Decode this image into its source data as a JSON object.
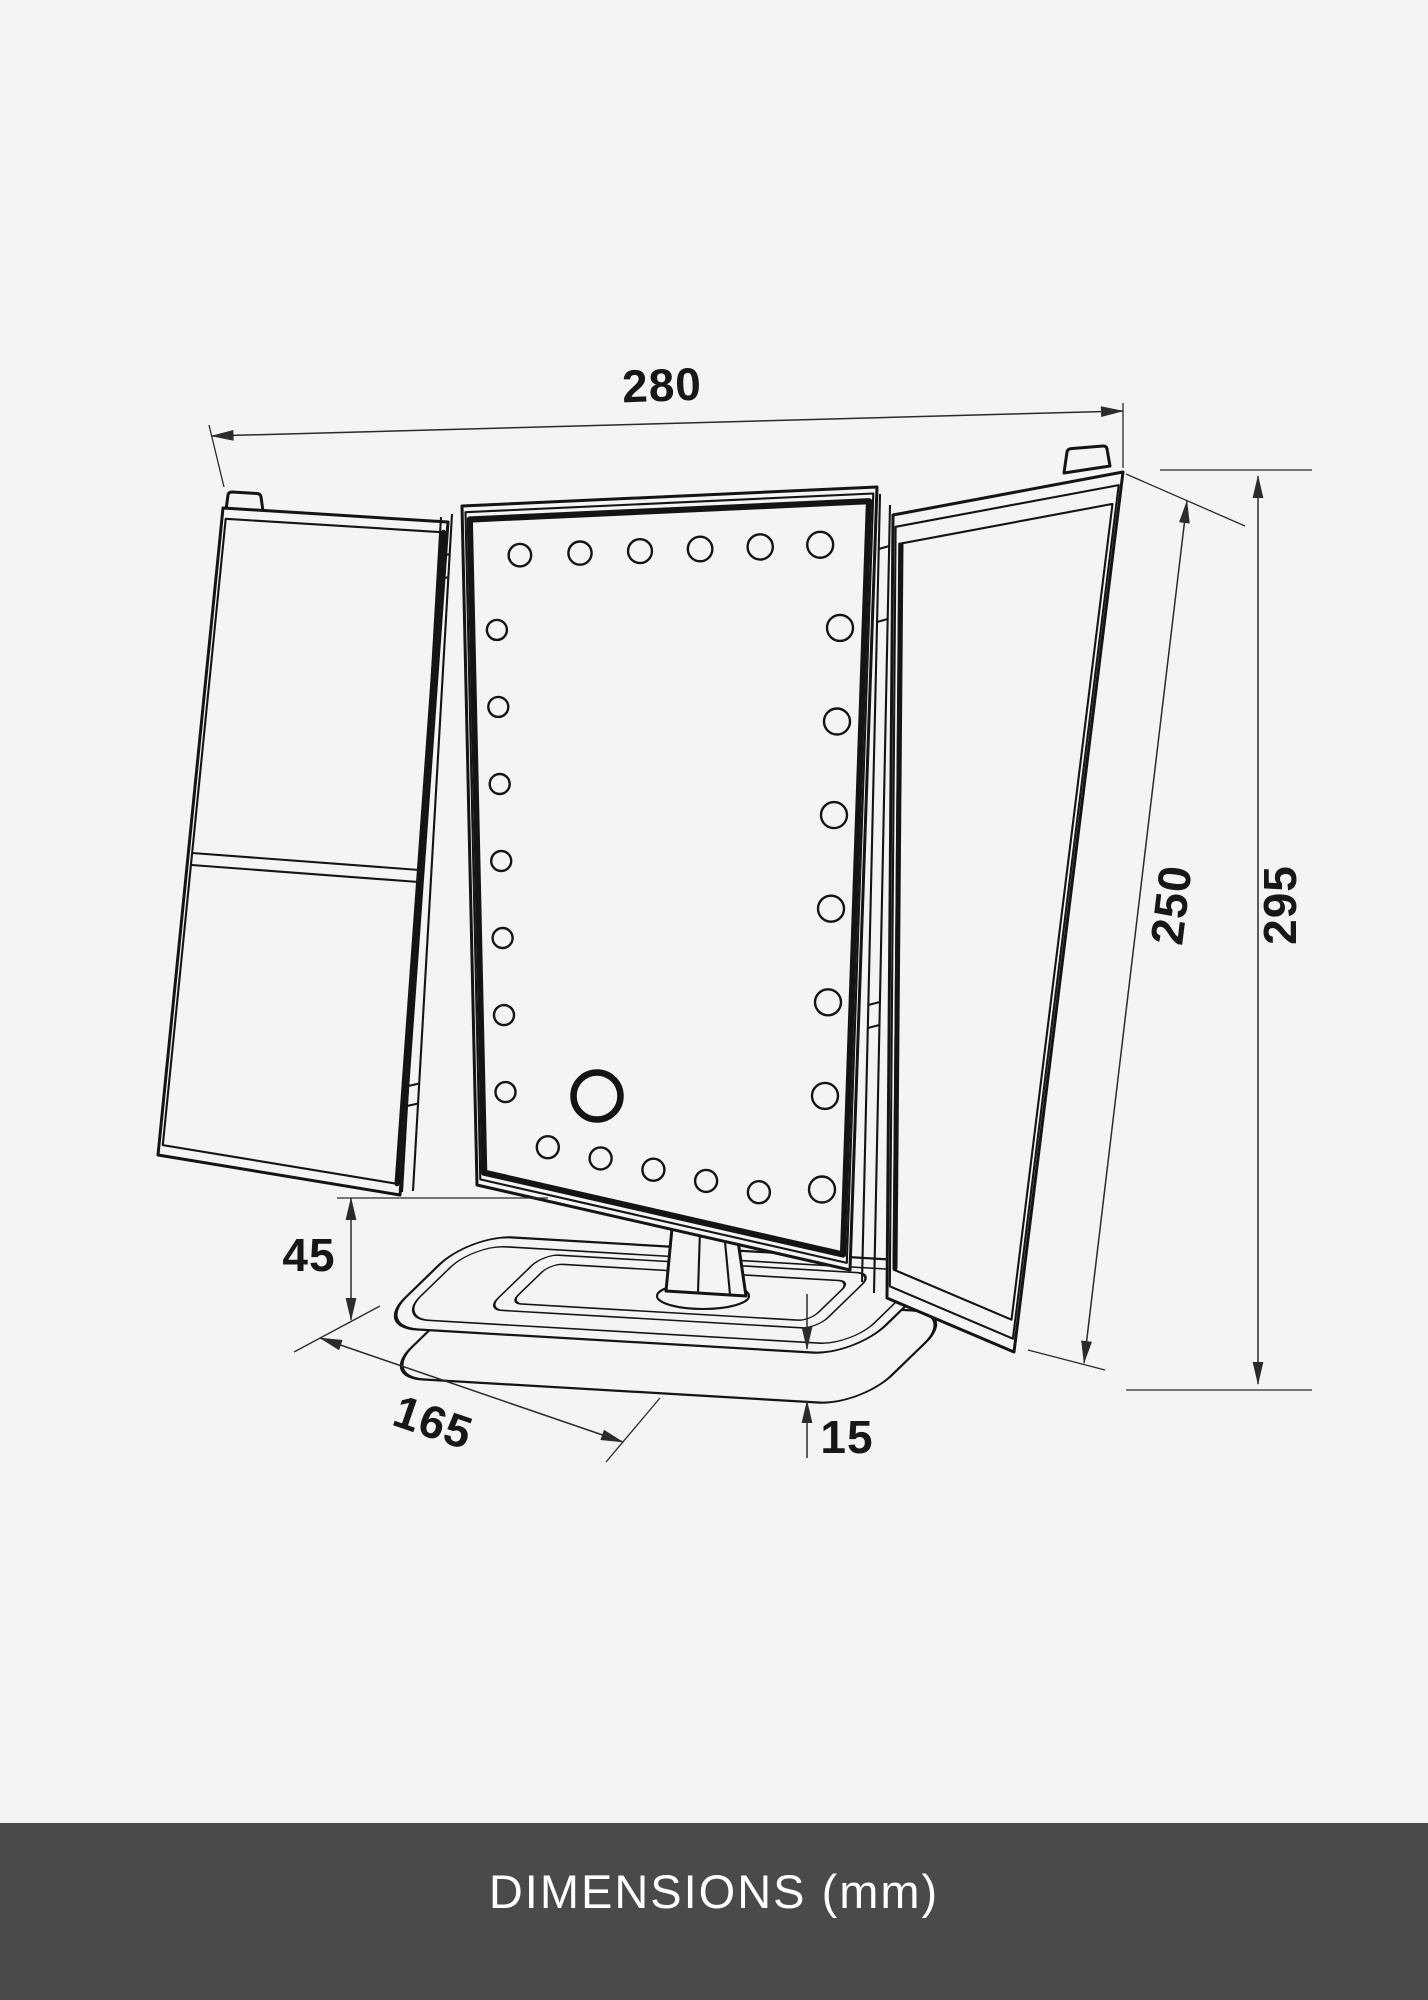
{
  "caption": {
    "text": "DIMENSIONS (mm)"
  },
  "dimensions": {
    "width_top": "280",
    "panel_height": "250",
    "total_height": "295",
    "base_height": "45",
    "base_depth": "165",
    "base_thickness": "15"
  },
  "drawing": {
    "led_counts": {
      "top": 6,
      "left": 7,
      "right": 7,
      "bottom": 5
    },
    "has_touch_button": true
  },
  "colors": {
    "background": "#f4f4f6",
    "line": "#141417",
    "dimension": "#2b2b2e",
    "bar_background": "#4a4a4c",
    "caption_text": "#ffffff"
  }
}
